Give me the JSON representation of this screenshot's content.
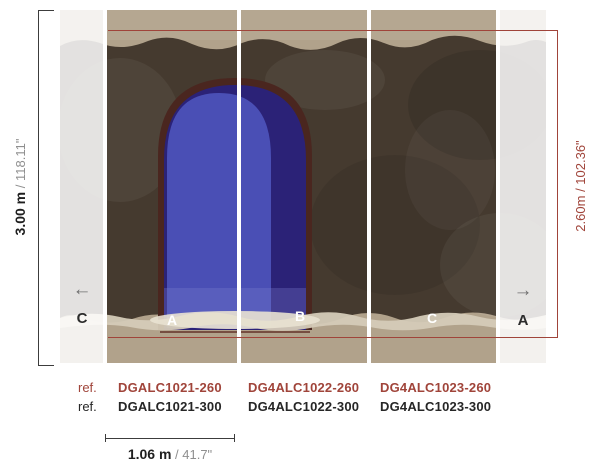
{
  "dimensions": {
    "total_height": {
      "metric": "3.00 m",
      "separator": " / ",
      "imperial": "118.11\""
    },
    "print_height": {
      "metric": "2.60m",
      "separator": " / ",
      "imperial": "102.36\""
    },
    "panel_width": {
      "metric": "1.06 m",
      "separator": " / ",
      "imperial": "41.7\""
    }
  },
  "references": {
    "row_260": {
      "label": "ref.",
      "codes": [
        "DGALC1021-260",
        "DG4ALC1022-260",
        "DG4ALC1023-260"
      ]
    },
    "row_300": {
      "label": "ref.",
      "codes": [
        "DGALC1021-300",
        "DG4ALC1022-300",
        "DG4ALC1023-300"
      ]
    }
  },
  "panels": {
    "white_labels": [
      "A",
      "B",
      "C"
    ],
    "left_repeat": {
      "arrow": "←",
      "label": "C"
    },
    "right_repeat": {
      "arrow": "→",
      "label": "A"
    }
  },
  "colors": {
    "annotation_red": "#a0443a",
    "annotation_dark": "#2e2e2e",
    "dim_gray": "#8f8f8f",
    "wall_tan": "#b1a28b",
    "wall_dark": "#453a2f",
    "arch_outline": "#4a261f",
    "arch_navy": "#2b2277",
    "arch_blue": "#4a4fb5",
    "torn_edge": "#d5cbb8"
  }
}
